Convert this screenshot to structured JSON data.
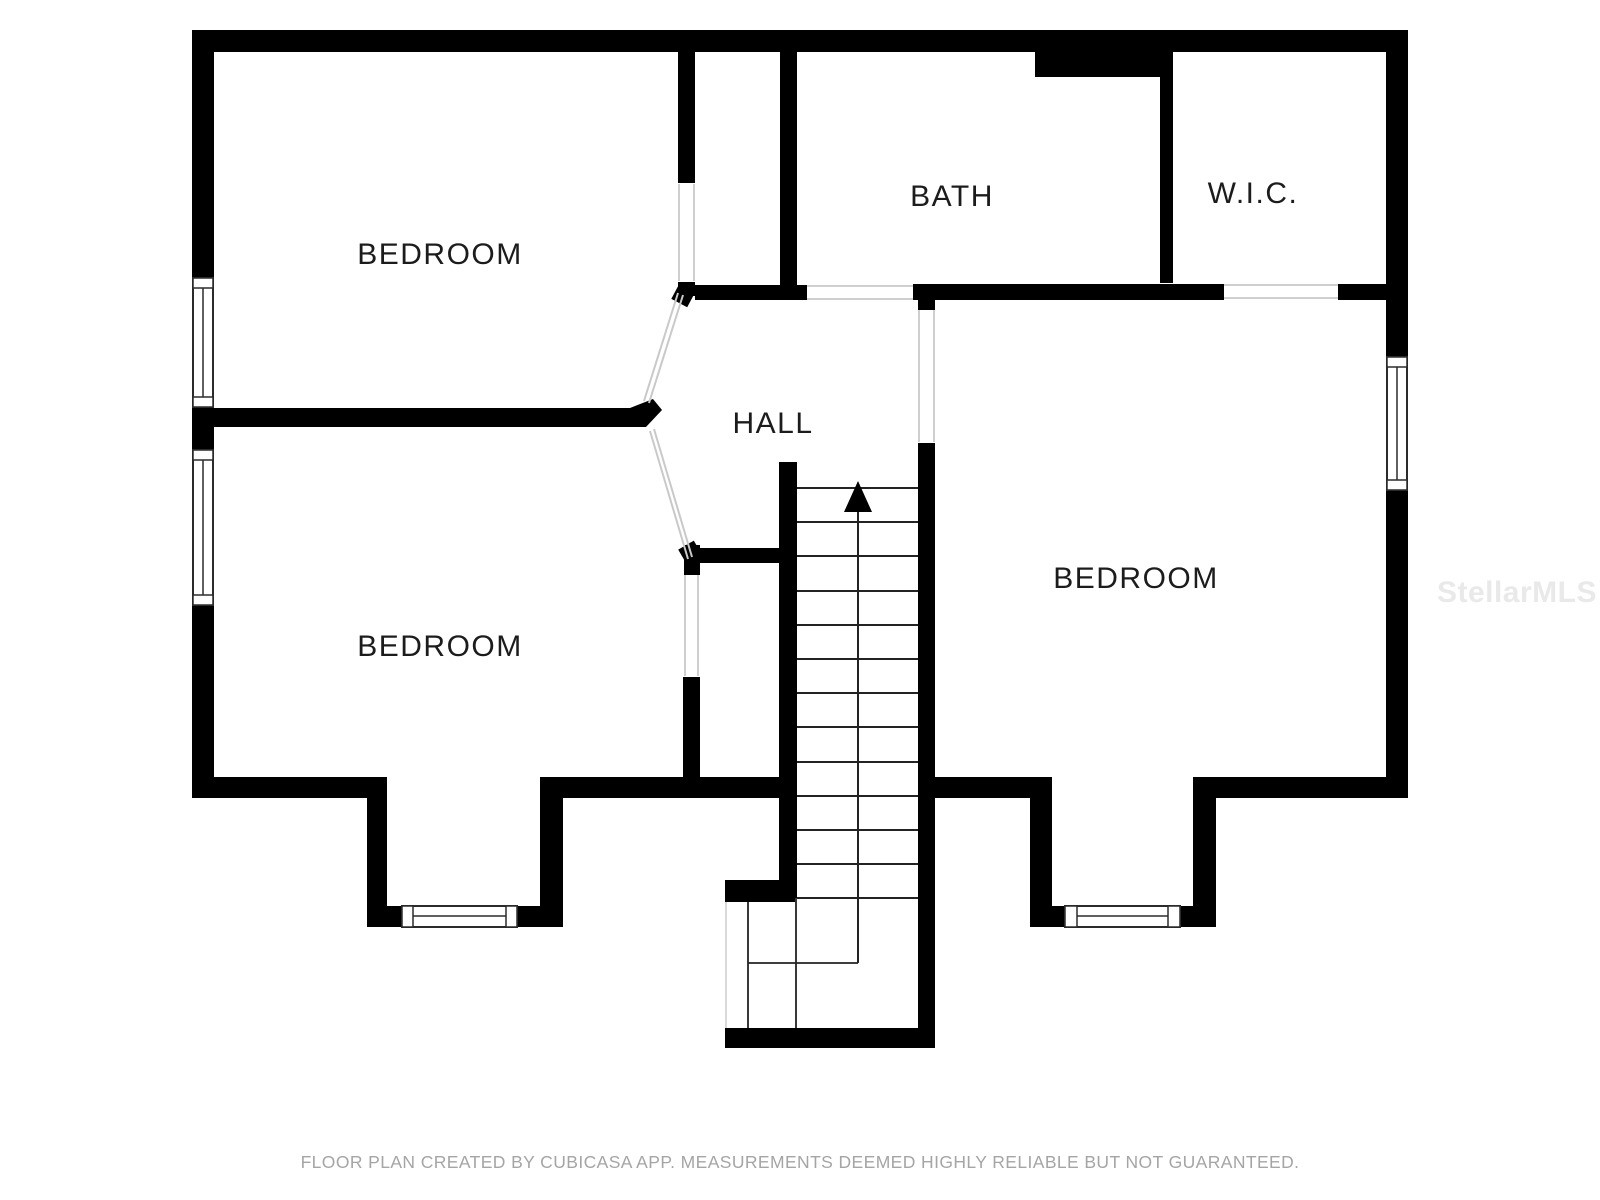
{
  "floor_plan": {
    "rooms": {
      "bedroom_top_left": {
        "label": "BEDROOM"
      },
      "bath": {
        "label": "BATH"
      },
      "wic": {
        "label": "W.I.C."
      },
      "hall": {
        "label": "HALL"
      },
      "bedroom_right": {
        "label": "BEDROOM"
      },
      "bedroom_bottom_left": {
        "label": "BEDROOM"
      }
    },
    "stairs": {
      "direction": "up",
      "arrow_icon": "up-arrow"
    },
    "watermark": "StellarMLS",
    "footer": "FLOOR PLAN CREATED BY CUBICASA APP. MEASUREMENTS DEEMED HIGHLY RELIABLE BUT NOT GUARANTEED.",
    "colors": {
      "wall": "#000000",
      "background": "#ffffff",
      "room_label": "#1c1c1c",
      "thin_line": "#232323",
      "door_line": "#cfcfcf",
      "footer_text": "#a5a5a5",
      "watermark": "#e9e9e9"
    }
  }
}
